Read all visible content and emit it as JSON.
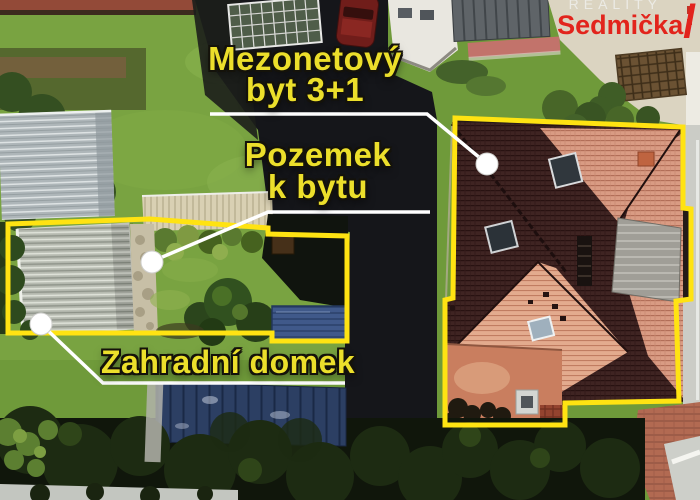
{
  "annotations": {
    "apartment": {
      "line1": "Mezonetový",
      "line2": "byt 3+1"
    },
    "land": {
      "line1": "Pozemek",
      "line2": "k bytu"
    },
    "garden_house": {
      "label": "Zahradní domek"
    }
  },
  "watermark": {
    "tagline": "REALITY",
    "brand": "Sedmička",
    "slash": "/"
  },
  "colors": {
    "outline_yellow": "#ffe312",
    "label_yellow": "#ecdf2b",
    "leader_white": "#ffffff",
    "brand_red": "#e2241c"
  }
}
